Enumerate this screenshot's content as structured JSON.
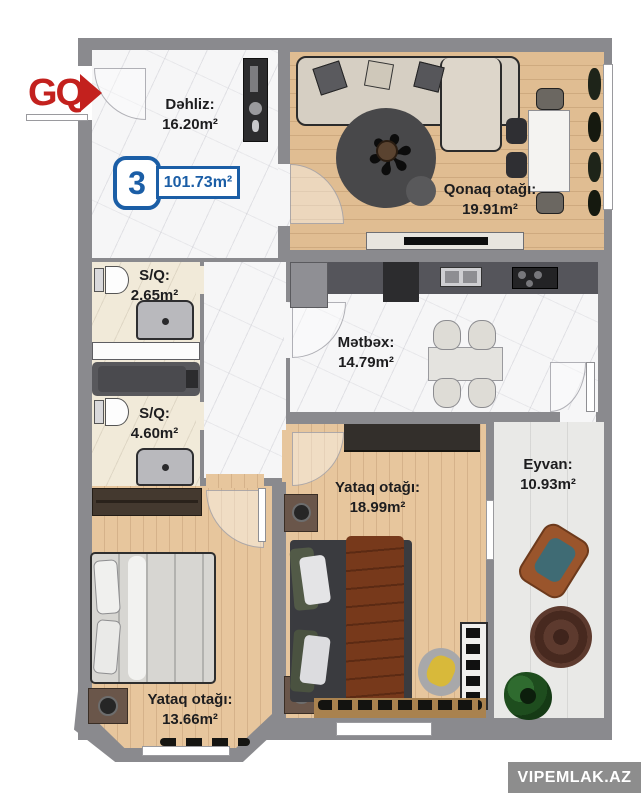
{
  "branding": {
    "logo": "GQ",
    "watermark": "VIPEMLAK.AZ"
  },
  "unit": {
    "number": "3",
    "total_area": "101.73m²"
  },
  "rooms": {
    "dehliz": {
      "name": "Dəhliz:",
      "area": "16.20m²"
    },
    "qonaq": {
      "name": "Qonaq otağı:",
      "area": "19.91m²"
    },
    "sq1": {
      "name": "S/Q:",
      "area": "2.65m²"
    },
    "sq2": {
      "name": "S/Q:",
      "area": "4.60m²"
    },
    "metbex": {
      "name": "Mətbəx:",
      "area": "14.79m²"
    },
    "yataq1": {
      "name": "Yataq otağı:",
      "area": "18.99m²"
    },
    "eyvan": {
      "name": "Eyvan:",
      "area": "10.93m²"
    },
    "yataq2": {
      "name": "Yataq otağı:",
      "area": "13.66m²"
    }
  },
  "colors": {
    "accent_blue": "#1b5ea6",
    "brand_red": "#c3211e",
    "wall_gray": "#8a8a8e"
  }
}
